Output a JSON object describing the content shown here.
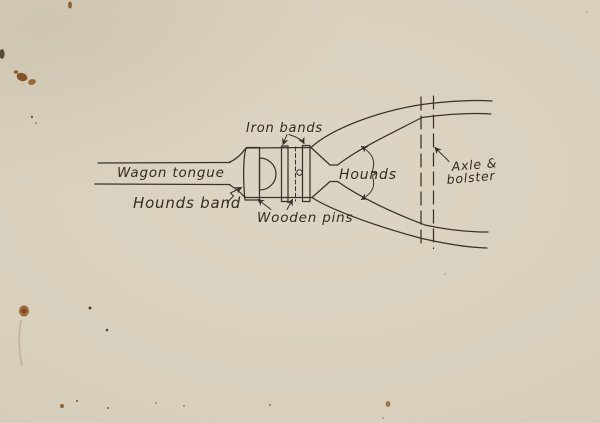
{
  "colors": {
    "paper": "#d7cfbc",
    "ink": "#38322a",
    "stain_brown": "#8a5420"
  },
  "diagram": {
    "labels": {
      "iron_bands": "Iron bands",
      "wagon_tongue": "Wagon tongue",
      "hounds_band": "Hounds band",
      "wooden_pins": "Wooden pins",
      "hounds": "Hounds",
      "axle_bolster_line1": "Axle &",
      "axle_bolster_line2": "bolster"
    }
  }
}
